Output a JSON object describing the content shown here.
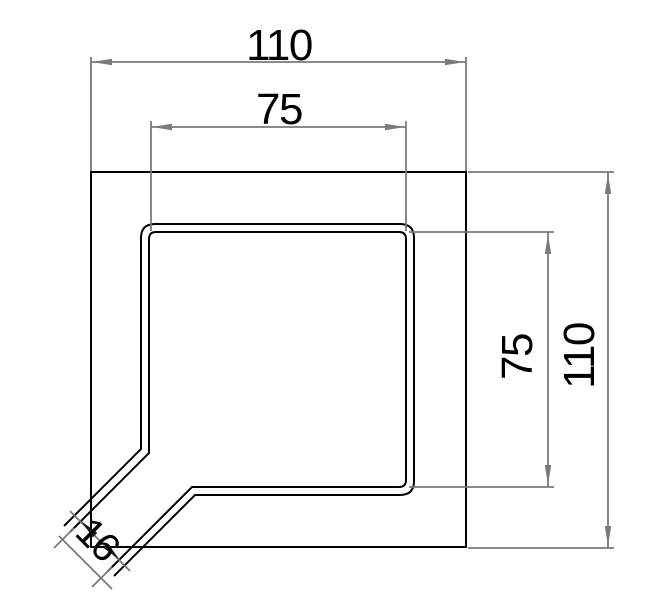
{
  "drawing": {
    "description": "Technical dimension drawing of a square corner channel unit with a 45-degree outlet spout at the bottom-left corner",
    "units": "mm"
  },
  "colors": {
    "background": "#ffffff",
    "geometry": "#000000",
    "dimension": "#7a7a7a",
    "arrow_dark": "#1a1a1a",
    "text": "#000000"
  },
  "dimensions": {
    "outer_width": {
      "label": "110",
      "orientation": "horizontal",
      "measures": "outer square width"
    },
    "inner_width": {
      "label": "75",
      "orientation": "horizontal",
      "measures": "inner channel width"
    },
    "outer_height": {
      "label": "110",
      "orientation": "vertical",
      "measures": "outer square height"
    },
    "inner_height": {
      "label": "75",
      "orientation": "vertical",
      "measures": "inner channel height"
    },
    "outlet_width": {
      "label": "16",
      "orientation": "diagonal-45",
      "measures": "outlet spout width"
    }
  }
}
